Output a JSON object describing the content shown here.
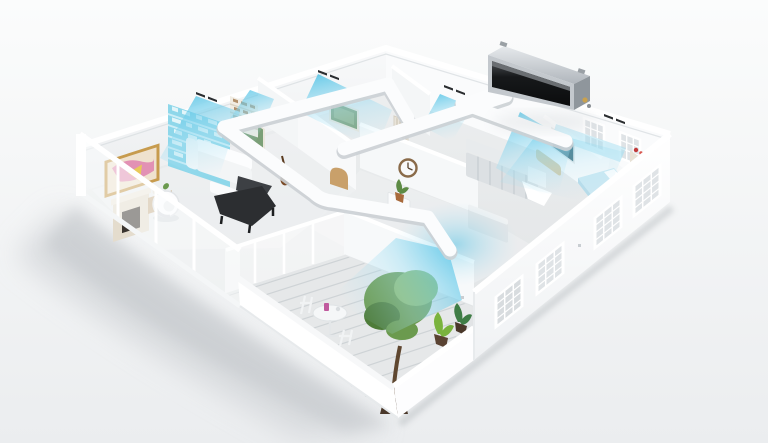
{
  "scene": {
    "type": "3d-cutaway-floorplan-with-ducted-air-conditioning",
    "components": {
      "unit": "ducted-indoor-unit",
      "duct_network": [
        "main-trunk",
        "bedroom-branch",
        "top-rooms-branch",
        "living-balcony-duct"
      ],
      "rooms": [
        "living-room",
        "study",
        "hallway",
        "bathroom",
        "kitchen",
        "bedroom",
        "balcony"
      ],
      "airflow_vents": [
        "study-vent",
        "living-room-vent",
        "top-room-vent",
        "bathroom-vent",
        "bedroom-vent",
        "kitchen-vent",
        "balcony-vent"
      ]
    }
  },
  "colors": {
    "background_top": "#fbfcfc",
    "background_bottom": "#ebedef",
    "shadow": "#c2c6ca",
    "wall": "#ffffff",
    "wall_inner": "#f4f6f7",
    "wall_edge": "#d8dcdf",
    "floor": "#e9ebec",
    "floor_dark": "#dde0e2",
    "deck_line": "#c9ced1",
    "duct": "#fbfcfd",
    "duct_shade": "#ccd1d5",
    "vent_slot": "#2a2d30",
    "airflow_strong": "#3fbde4",
    "airflow_soft": "#a5dff2",
    "bookshelf": "#8ed7ea",
    "unit_body": "#c3c8cd",
    "unit_body_dark": "#8f969c",
    "unit_grille": "#17191b",
    "unit_pipe": "#c9a14e",
    "piano": "#2c2e31",
    "piano_lid": "#3d4044",
    "guitar": "#7a4a26",
    "art_pink": "#e291b4",
    "art_yellow": "#e8c95a",
    "art_gold_frame": "#c79b4e",
    "art_green": "#7b9f77",
    "art_teal": "#41707f",
    "wood": "#c9a06a",
    "bench": "#d8c69c",
    "bed": "#cde9f3",
    "cabinet": "#dce0e3",
    "cabinet_dark": "#c6ccd0",
    "tree_dark": "#4e7c39",
    "tree_mid": "#6b9a4e",
    "tree_light": "#8ab868",
    "pot": "#4a382a",
    "table": "#f5f7f8",
    "cup_pink": "#c05a9e",
    "clock_rim": "#8a6b4a",
    "fireplace": "#e4dccd",
    "firebox": "#3a342e"
  }
}
